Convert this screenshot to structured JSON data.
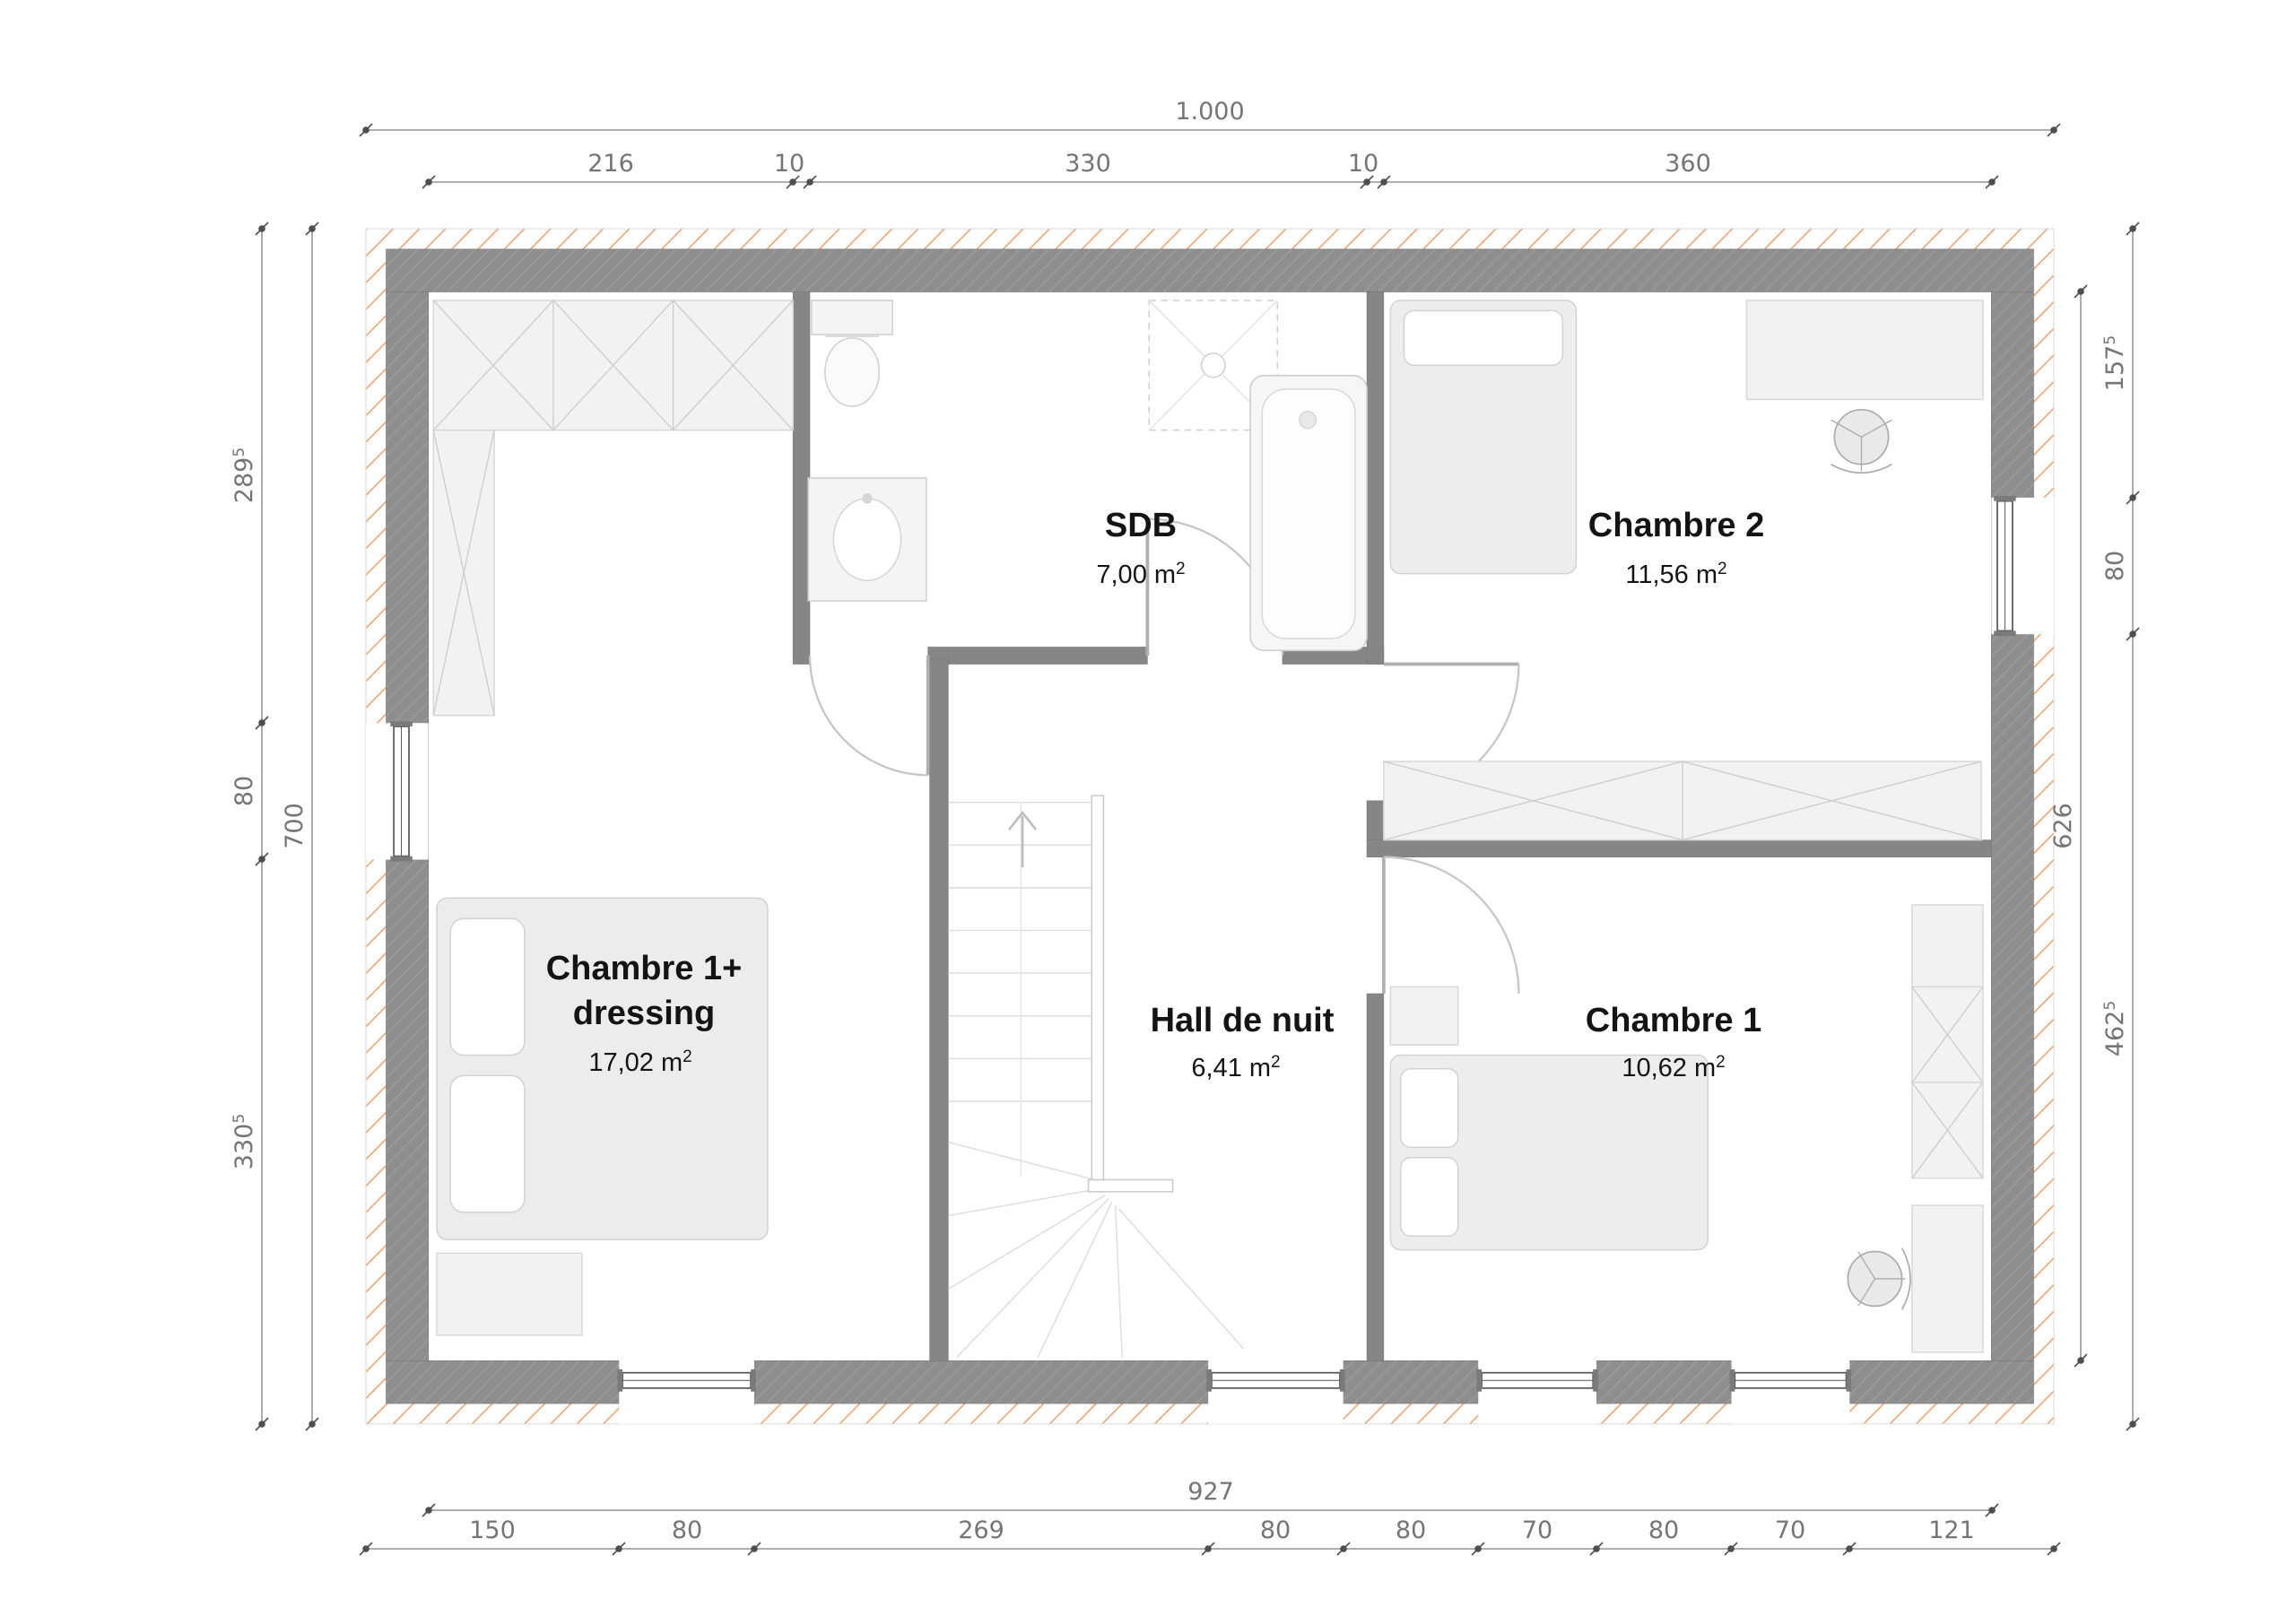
{
  "plan": {
    "rooms": [
      {
        "id": "sdb",
        "name": "SDB",
        "area": "7,00 m",
        "area_sup": "2"
      },
      {
        "id": "chambre2",
        "name": "Chambre 2",
        "area": "11,56 m",
        "area_sup": "2"
      },
      {
        "id": "chambre1-dressing",
        "name_line1": "Chambre 1+",
        "name_line2": "dressing",
        "area": "17,02 m",
        "area_sup": "2"
      },
      {
        "id": "hall-de-nuit",
        "name": "Hall de nuit",
        "area": "6,41 m",
        "area_sup": "2"
      },
      {
        "id": "chambre1",
        "name": "Chambre 1",
        "area": "10,62 m",
        "area_sup": "2"
      }
    ]
  },
  "dimensions": {
    "top_total": "1.000",
    "top_segments": [
      "216",
      "10",
      "330",
      "10",
      "360"
    ],
    "left_segments": [
      {
        "v": "289",
        "sup": "5"
      },
      {
        "v": "80",
        "sup": ""
      },
      {
        "v": "330",
        "sup": "5"
      }
    ],
    "left_total": "700",
    "right_segments": [
      {
        "v": "157",
        "sup": "5"
      },
      {
        "v": "80",
        "sup": ""
      },
      {
        "v": "462",
        "sup": "5"
      }
    ],
    "right_inner_total": "626",
    "bottom_inner_total": "927",
    "bottom_segments": [
      "150",
      "80",
      "269",
      "80",
      "80",
      "70",
      "80",
      "70",
      "121"
    ]
  },
  "colors": {
    "wall_gray": "#8e8e8e",
    "partition_gray": "#868686",
    "insulation_orange": "#f0a470",
    "dimension_text": "#757575",
    "room_text": "#141414"
  }
}
